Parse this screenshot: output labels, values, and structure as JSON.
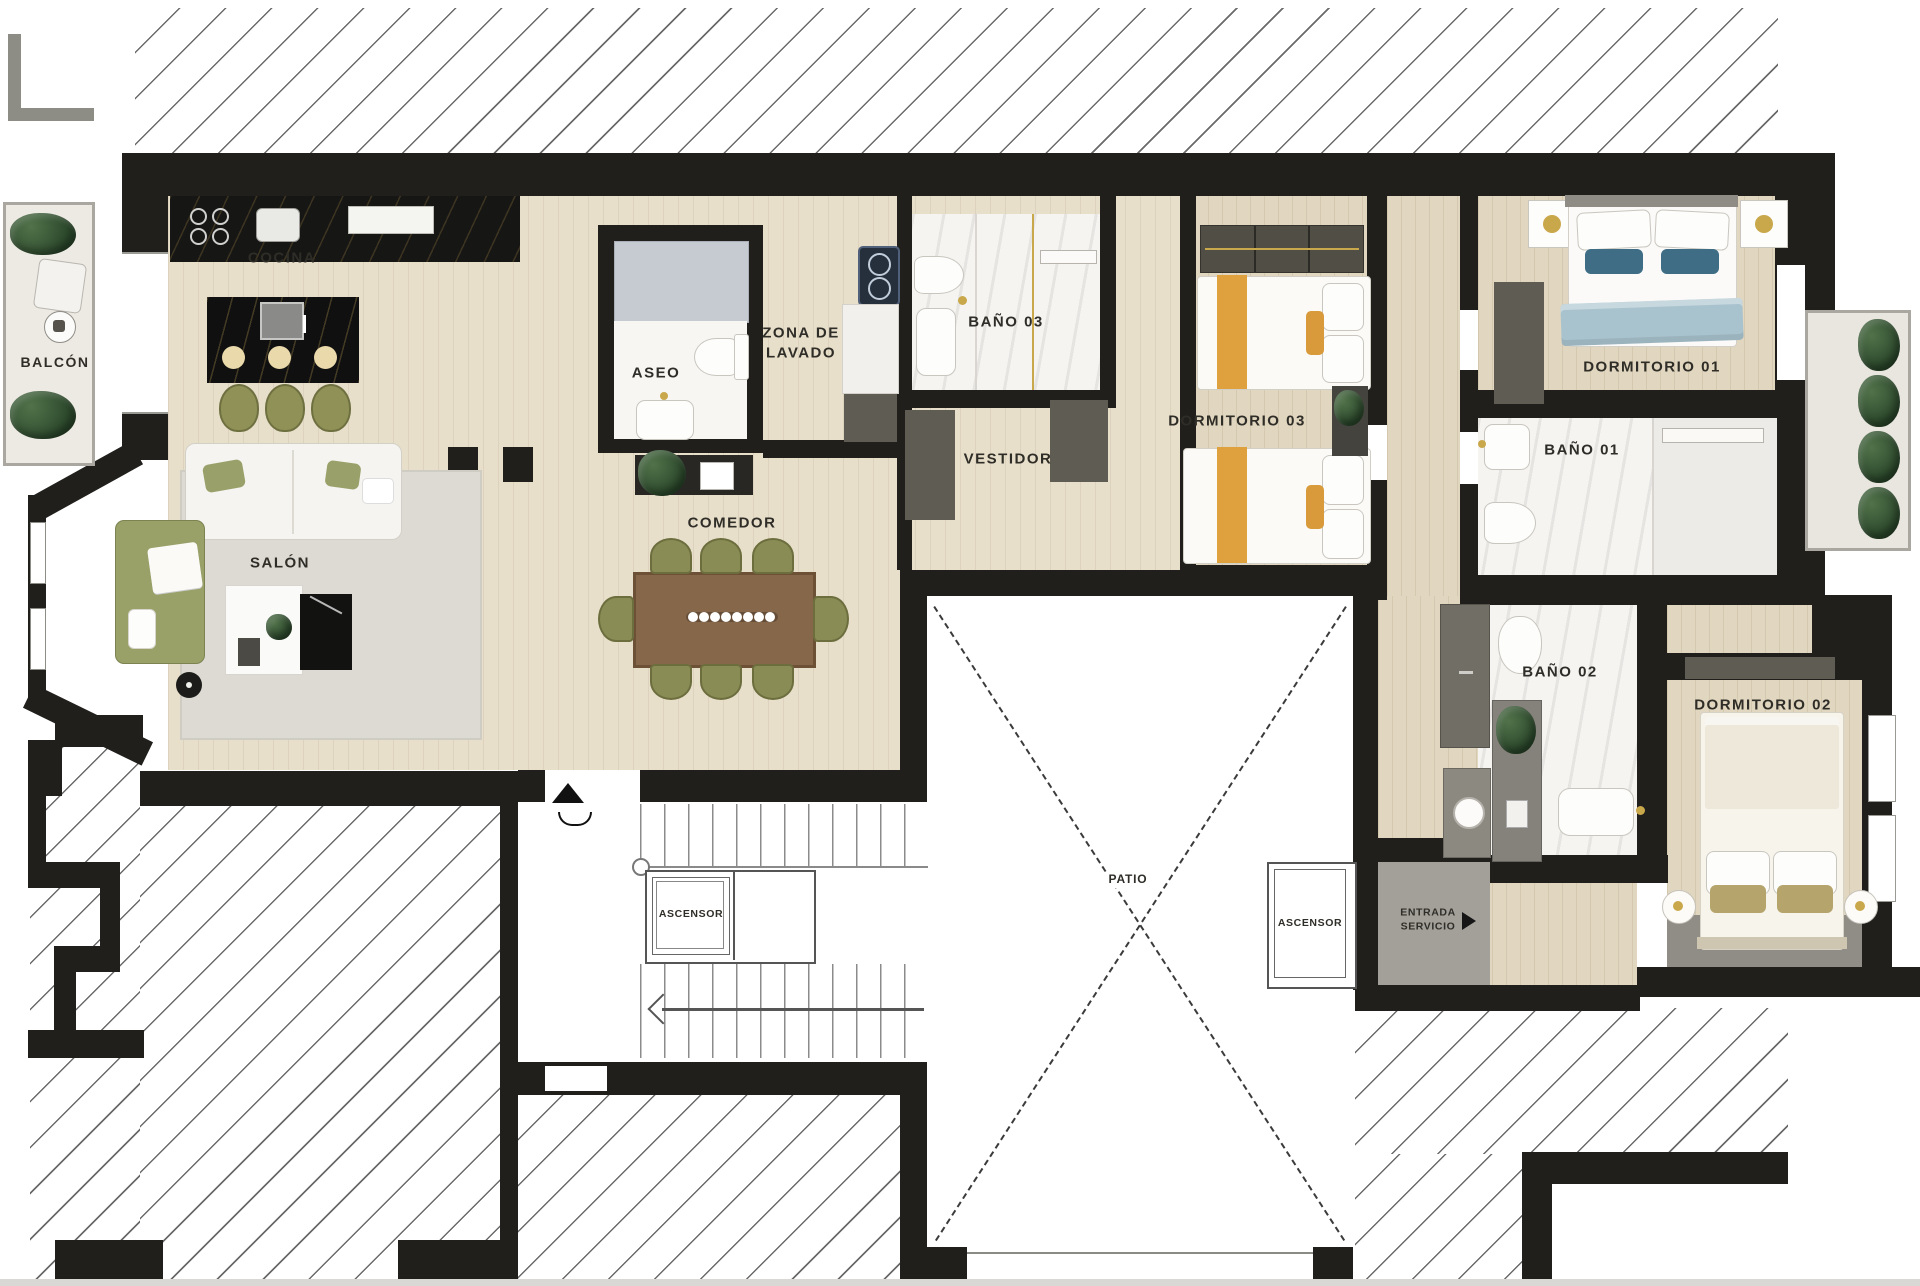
{
  "plan": {
    "type": "apartment-floor-plan",
    "language": "es",
    "rooms": {
      "balcon": {
        "label": "BALCÓN"
      },
      "cocina": {
        "label": "COCINA"
      },
      "salon": {
        "label": "SALÓN"
      },
      "comedor": {
        "label": "COMEDOR"
      },
      "aseo": {
        "label": "ASEO"
      },
      "zona_lavado": {
        "line1": "ZONA DE",
        "line2": "LAVADO"
      },
      "bano03": {
        "label": "BAÑO 03"
      },
      "vestidor": {
        "label": "VESTIDOR"
      },
      "dormitorio03": {
        "label": "DORMITORIO 03"
      },
      "dormitorio01": {
        "label": "DORMITORIO 01"
      },
      "bano01": {
        "label": "BAÑO 01"
      },
      "bano02": {
        "label": "BAÑO 02"
      },
      "dormitorio02": {
        "label": "DORMITORIO 02"
      },
      "patio": {
        "label": "PATIO"
      },
      "entrada_servicio": {
        "line1": "ENTRADA",
        "line2": "SERVICIO"
      },
      "ascensor_left": {
        "label": "ASCENSOR"
      },
      "ascensor_right": {
        "label": "ASCENSOR"
      }
    },
    "colors": {
      "wall": "#201f1c",
      "wood_floor": "#e8dfcb",
      "marble_floor": "#f5f4f1",
      "island_stone": "#121212",
      "accent_orange": "#dfa13e",
      "accent_blue": "#3e6d85",
      "sofa_green": "#99a169",
      "service_gray": "#a3a09a"
    }
  }
}
